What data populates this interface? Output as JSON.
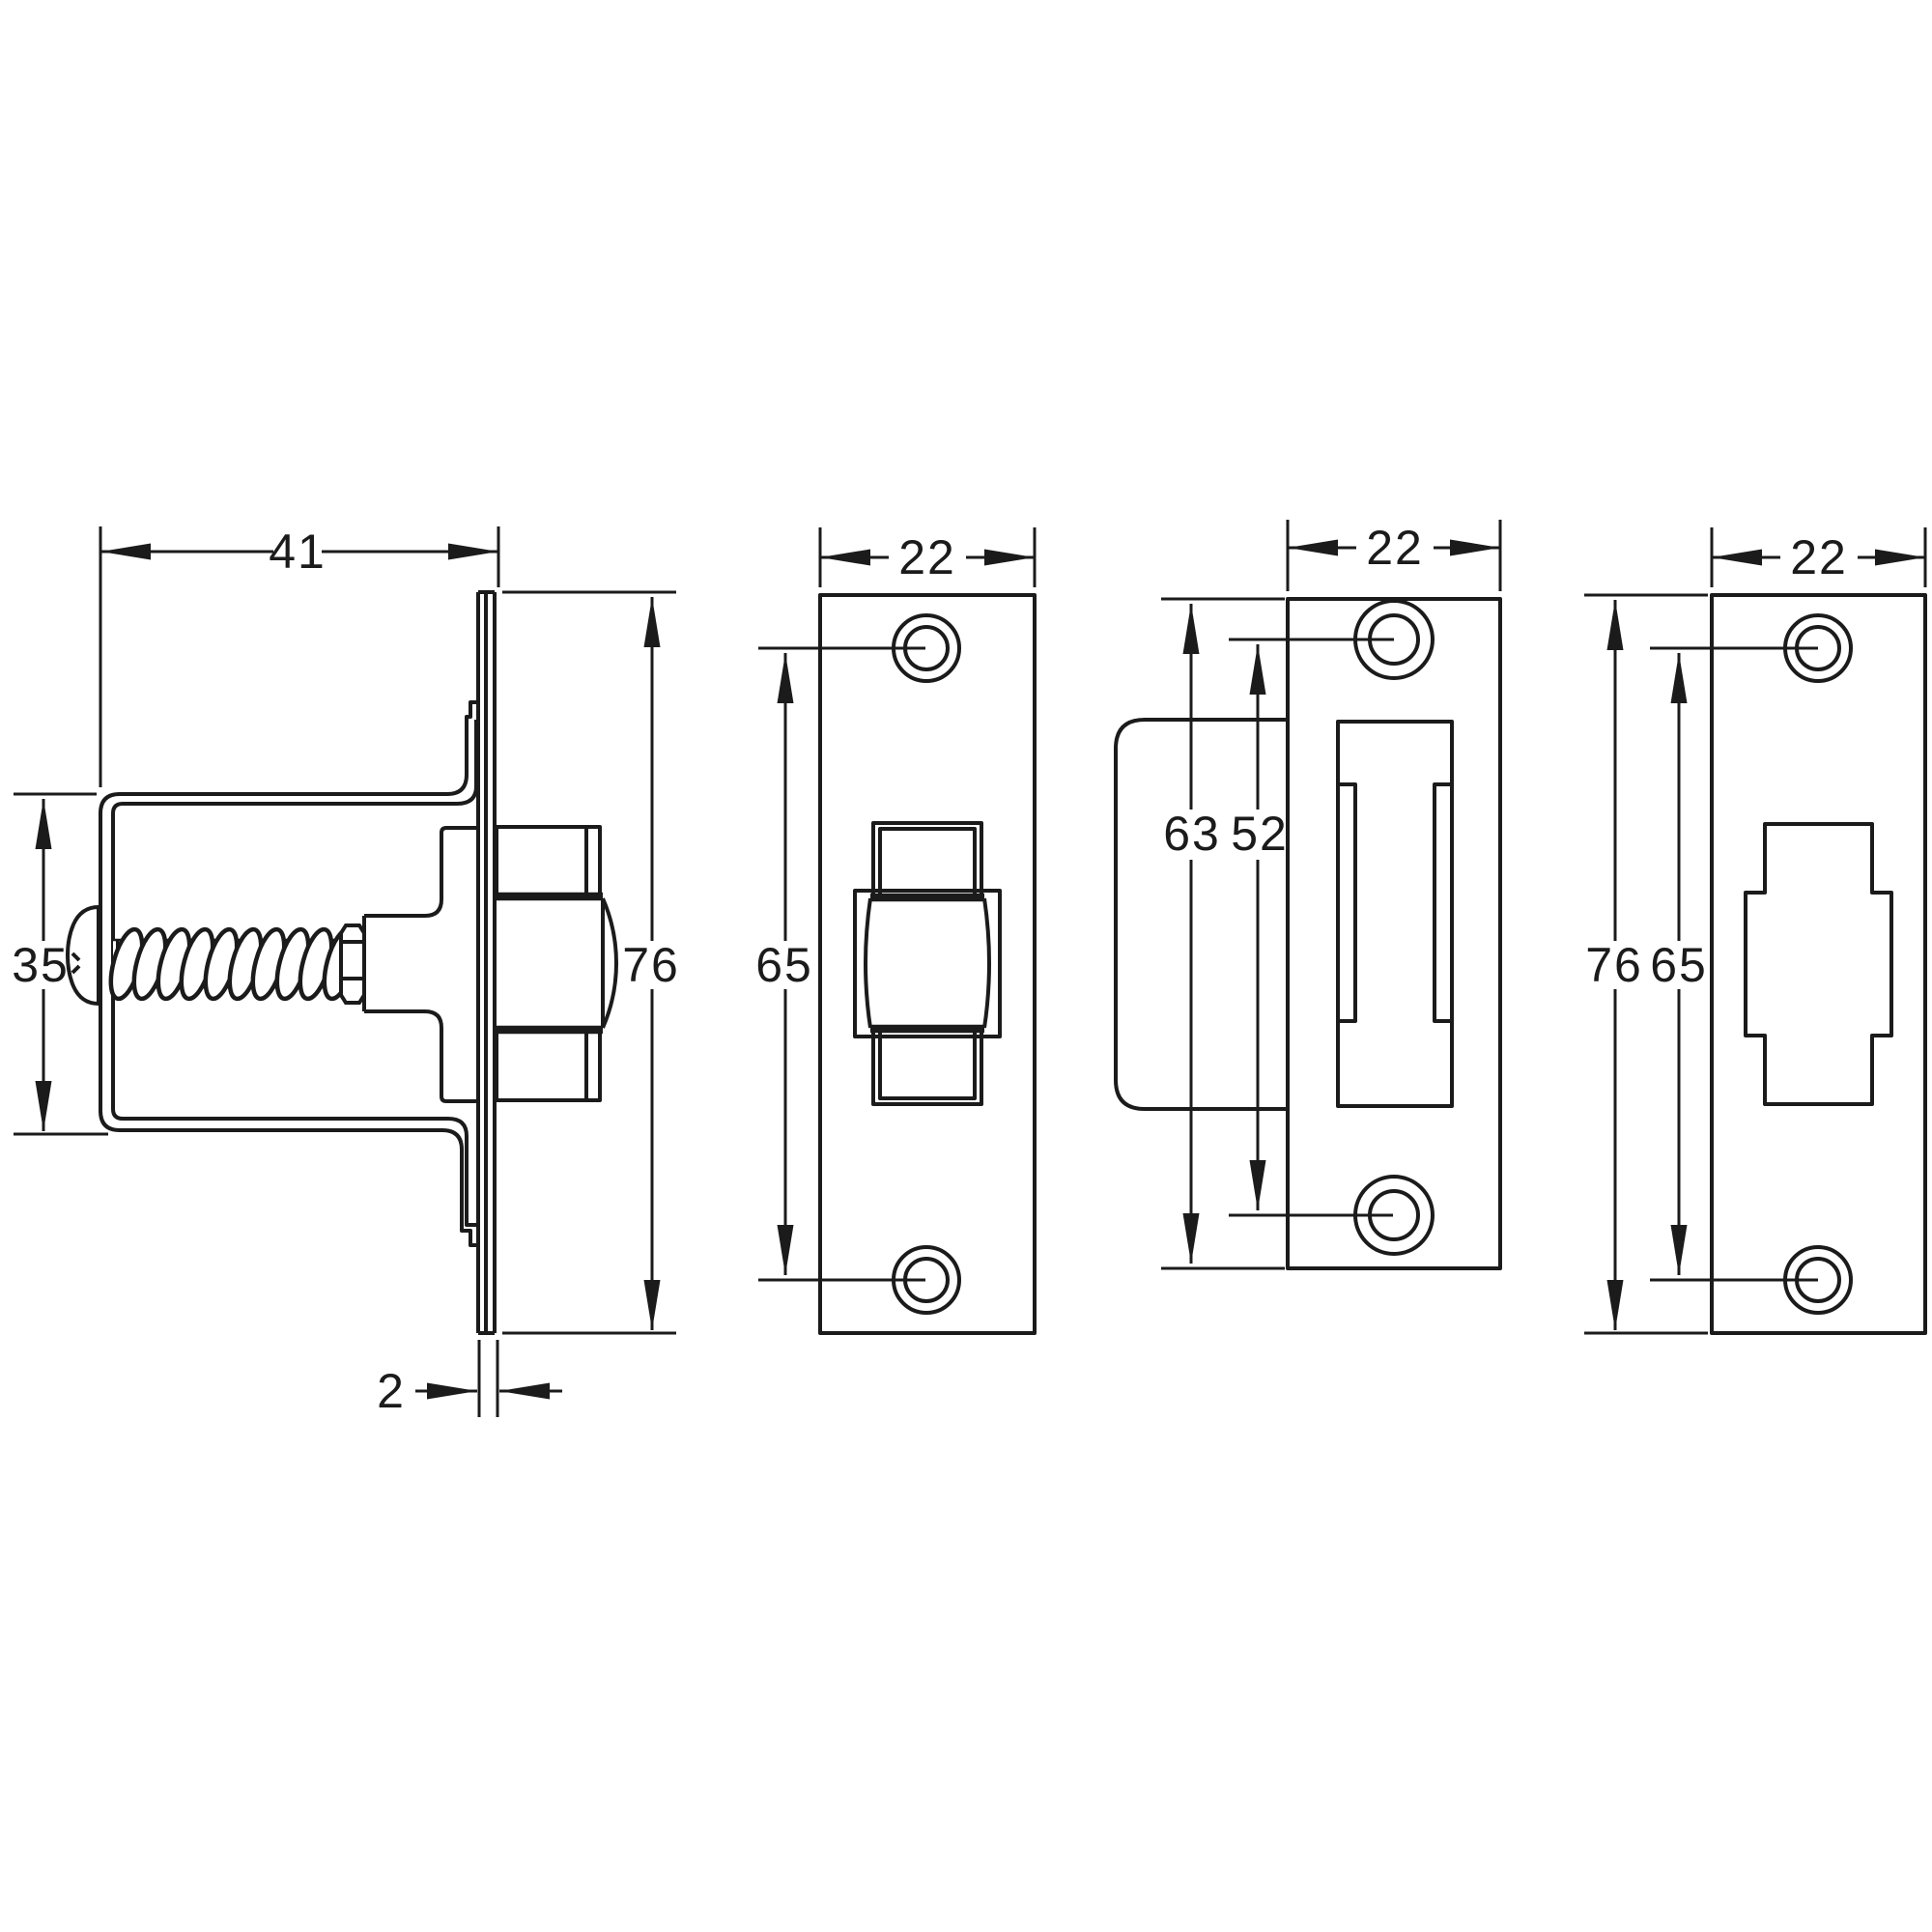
{
  "drawing": {
    "kind": "technical-dimension-drawing",
    "subject": "spring roller catch and strike plates",
    "units_shown": "mm (numbers only)",
    "colors": {
      "line": "#1b1b1b",
      "background": "#ffffff"
    }
  },
  "views": [
    {
      "label": "catch side view",
      "dims": {
        "depth": "41",
        "bracket_height": "35",
        "plate_height": "76",
        "plate_thickness": "2"
      }
    },
    {
      "label": "catch face plate front view",
      "dims": {
        "width": "22",
        "hole_spacing": "65"
      }
    },
    {
      "label": "strike plate with dust box side view",
      "dims": {
        "width": "22",
        "plate_height": "63",
        "hole_spacing": "52"
      }
    },
    {
      "label": "strike plate front view",
      "dims": {
        "width": "22",
        "plate_height": "76",
        "hole_spacing": "65"
      }
    }
  ]
}
